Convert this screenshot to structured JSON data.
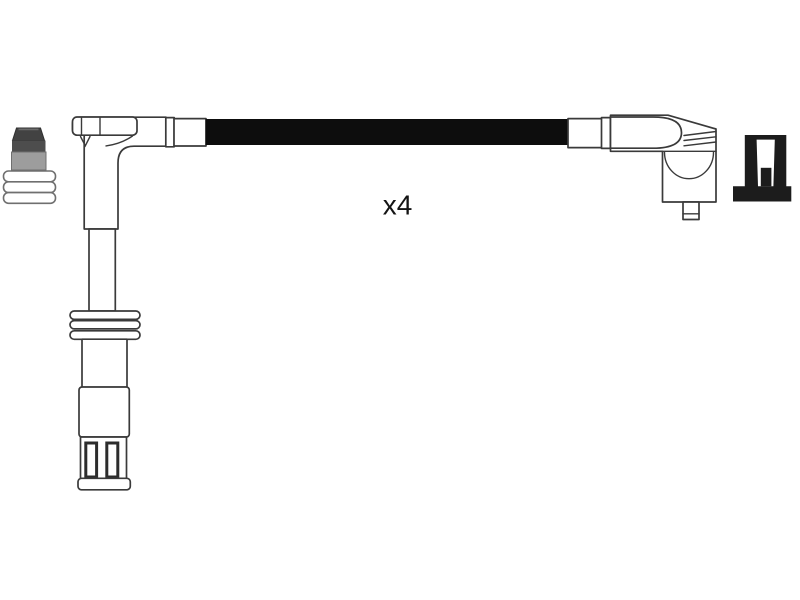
{
  "illustration": {
    "quantity_label": "x4",
    "parts": [
      {
        "name": "terminal-nut-connector",
        "position": "far-left"
      },
      {
        "name": "straight-spark-plug-boot",
        "position": "left"
      },
      {
        "name": "ignition-lead-cable",
        "position": "center"
      },
      {
        "name": "angled-coil-boot",
        "position": "right"
      },
      {
        "name": "terminal-clip",
        "position": "far-right"
      }
    ]
  },
  "colors": {
    "background": "#ffffff",
    "outline": "#3a3a3a",
    "cable": "#0d0d0d",
    "terminal_dark": "#1c1c1c",
    "nut_cap": "#424242",
    "nut_band": "#4d4d4d",
    "nut_collar": "#9d9d9d"
  }
}
